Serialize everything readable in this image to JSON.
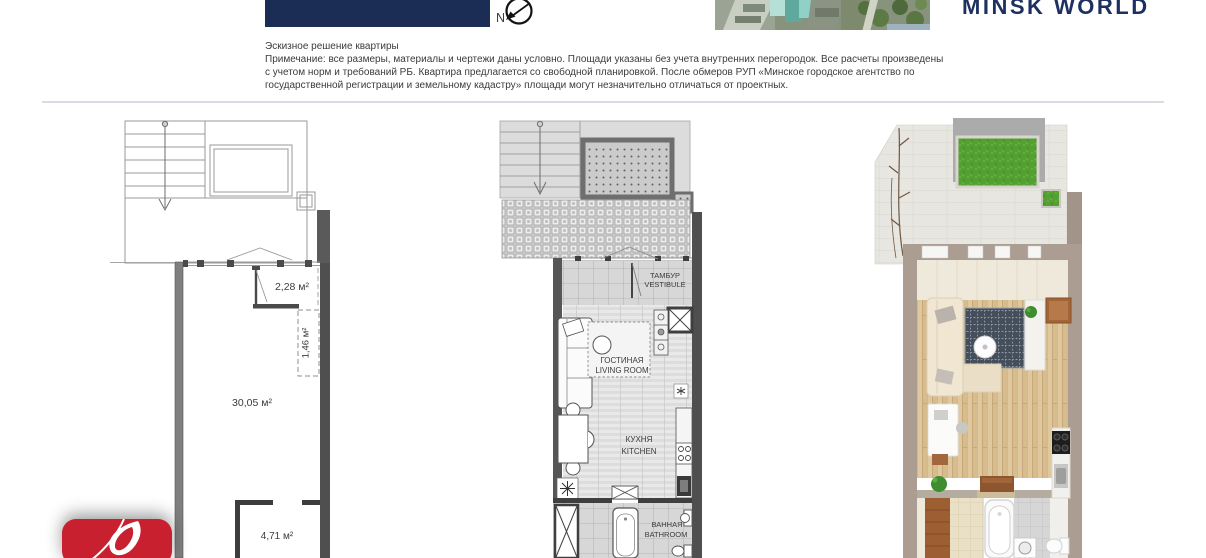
{
  "header": {
    "brand": "MINSK WORLD",
    "compass_label": "N"
  },
  "disclaimer": {
    "title": "Эскизное решение квартиры",
    "lines": [
      "Примечание: все размеры, материалы и чертежи даны условно. Площади указаны без учета внутренних перегородок. Все расчеты произведены",
      "с учетом норм и требований РБ. Квартира предлагается со свободной планировкой. После обмеров РУП «Минское городское агентство по",
      "государственной регистрации и земельному кадастру» площади могут незначительно отличаться от проектных."
    ]
  },
  "schematic_plan": {
    "area_entry": "2,28 м²",
    "area_niche": "1,46 м²",
    "area_main": "30,05 м²",
    "area_bath": "4,71 м²"
  },
  "furnished_plan": {
    "vestibule_ru": "ТАМБУР",
    "vestibule_en": "VESTIBULE",
    "living_ru": "ГОСТИНАЯ",
    "living_en": "LIVING ROOM",
    "kitchen_ru": "КУХНЯ",
    "kitchen_en": "KITCHEN",
    "bath_ru": "ВАННАЯ",
    "bath_en": "BATHROOM"
  },
  "colors": {
    "brand_navy": "#1e3061",
    "header_box_navy": "#1b2c55",
    "logo_red": "#c8202f",
    "divider": "#d7dde3"
  }
}
